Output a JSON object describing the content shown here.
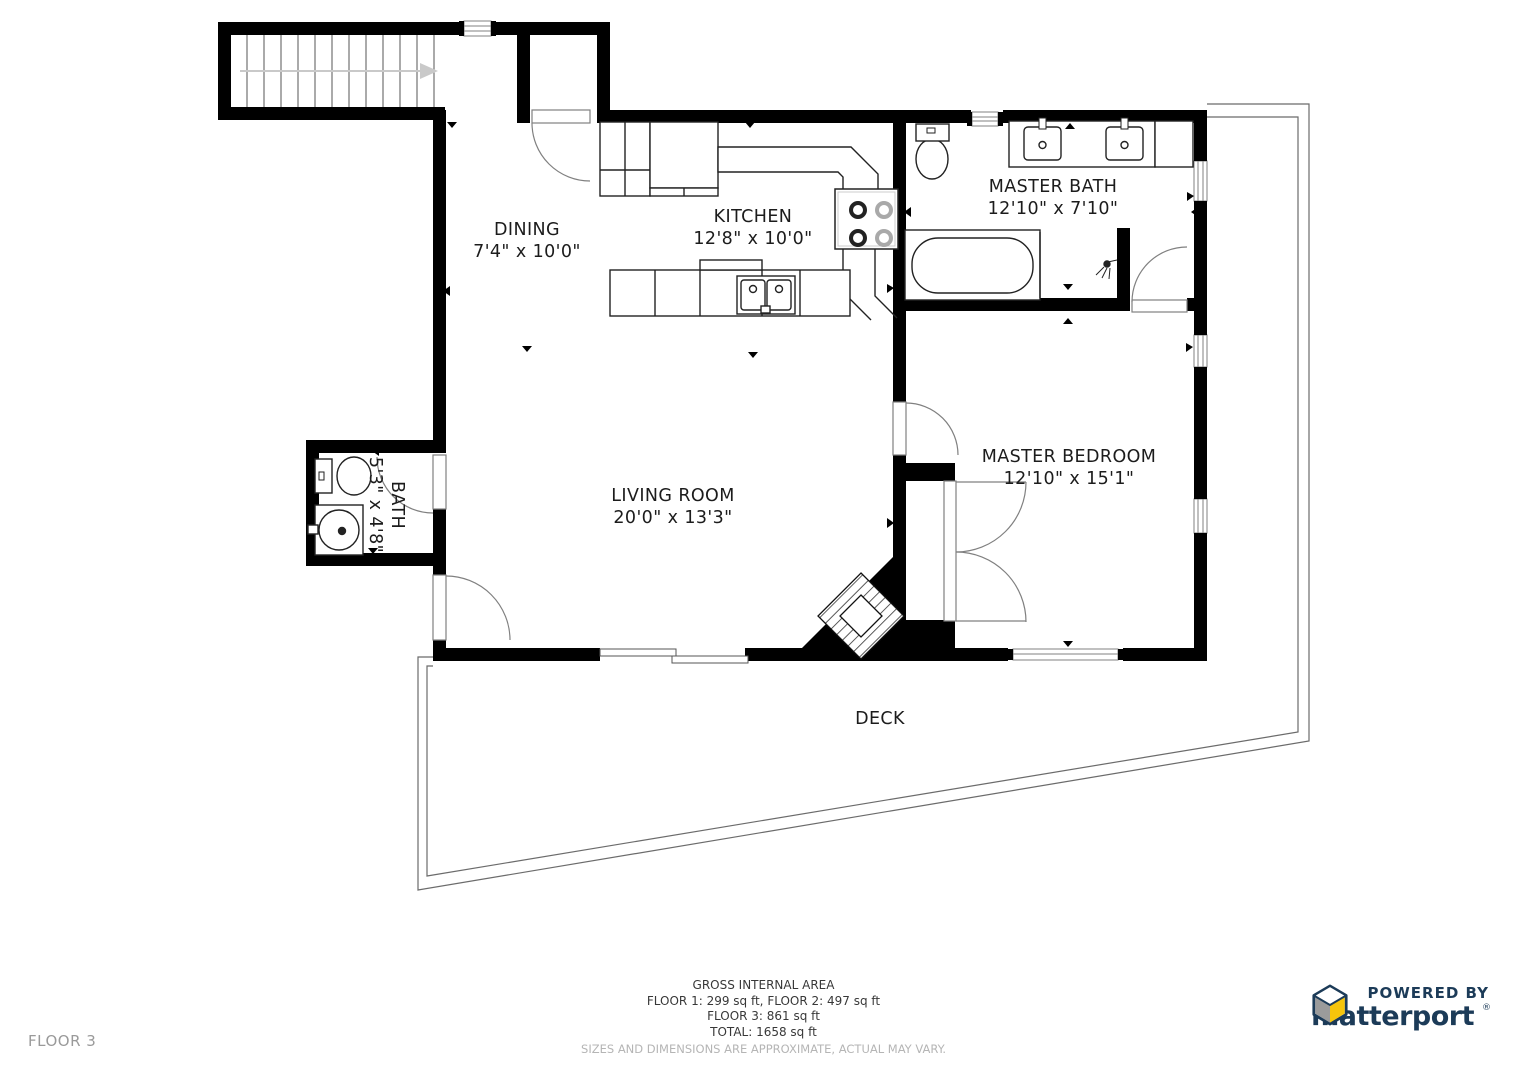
{
  "page": {
    "background": "#ffffff"
  },
  "rooms": [
    {
      "name": "DINING",
      "dims": "7'4\" x 10'0\""
    },
    {
      "name": "KITCHEN",
      "dims": "12'8\" x 10'0\""
    },
    {
      "name": "MASTER BATH",
      "dims": "12'10\" x 7'10\""
    },
    {
      "name": "LIVING ROOM",
      "dims": "20'0\" x 13'3\""
    },
    {
      "name": "MASTER BEDROOM",
      "dims": "12'10\" x 15'1\""
    },
    {
      "name": "BATH",
      "dims": "5'3\" x 4'8\""
    },
    {
      "name": "DECK",
      "dims": ""
    }
  ],
  "footer": {
    "floor_label": "FLOOR 3",
    "area_title": "GROSS INTERNAL AREA",
    "area_line1": "FLOOR 1: 299 sq ft, FLOOR 2: 497 sq ft",
    "area_line2": "FLOOR 3: 861 sq ft",
    "area_line3": "TOTAL: 1658 sq ft",
    "disclaimer": "SIZES AND DIMENSIONS ARE APPROXIMATE, ACTUAL MAY VARY."
  },
  "branding": {
    "powered_by": "POWERED BY",
    "brand": "matterport",
    "registered": "®",
    "colors": {
      "navy": "#1c3b58",
      "yellow": "#f6c50b",
      "gray": "#9b9b9b",
      "wall": "#000000"
    }
  }
}
